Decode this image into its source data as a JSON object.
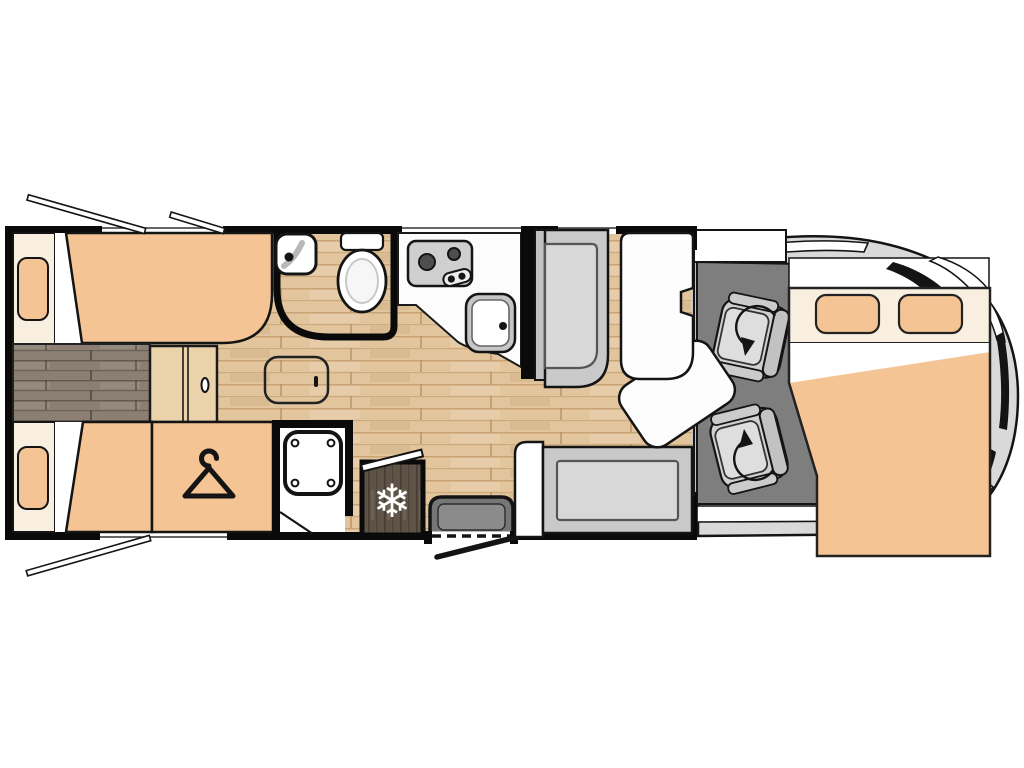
{
  "meta": {
    "title": "motorhome-floorplan-diagram",
    "canvas": {
      "width": 1024,
      "height": 768
    }
  },
  "colors": {
    "page_bg": "#ffffff",
    "outline": "#141414",
    "wall": "#0a0a0a",
    "mattress_orange": "#f5c494",
    "pillow_orange": "#f5c494",
    "cream": "#f9efe0",
    "wood_light_base": "#e2c59d",
    "wood_light_line": "#c19a6b",
    "wood_dark_base": "#8a7f72",
    "wood_dark_line": "#6a6156",
    "fridge_wood_base": "#5f5348",
    "fridge_wood_line": "#473d33",
    "cab_floor": "#7e7e7e",
    "vehicle_body": "#d9d9d9",
    "bench_outer": "#c9c9c9",
    "bench_back": "#c2c2c2",
    "cushion": "#d8d8d8",
    "cushion_edge": "#555555",
    "seat_base": "#d0d0d0",
    "seat_cushion": "#dedede",
    "counter_white": "#fcfcfc",
    "table_white": "#fdfdfd",
    "pure_white": "#ffffff",
    "stove_panel": "#cfcfcf",
    "burner_gray": "#4e4e4e",
    "sink_outer": "#c6c6c6",
    "step_fill": "#767676",
    "step_inner": "#8b8b8b",
    "basin_swoosh": "#b8b8b8",
    "toilet_inner": "#f6f6f6",
    "step_cabinet": "#ead2ab"
  },
  "icons": {
    "snowflake_glyph": "❄",
    "names": [
      "snowflake-icon",
      "hanger-icon",
      "rotation-arrow-icon",
      "window-flap",
      "door-swing-line"
    ]
  },
  "components": [
    "rear-twin-bed-upper",
    "rear-twin-bed-lower",
    "center-aisle",
    "aisle-step-cabinet",
    "wardrobe",
    "bathroom",
    "corner-washbasin",
    "toilet",
    "shower",
    "shower-tray",
    "kitchen-counter",
    "hob",
    "kitchen-sink",
    "refrigerator",
    "corridor-ottoman",
    "dinette-bench-forward",
    "dinette-bench-rear",
    "dinette-table",
    "table-leaf",
    "entry-step",
    "entry-door",
    "cab-floor",
    "swivel-seat-front",
    "swivel-seat-rear",
    "vehicle-front-body",
    "windshield",
    "drop-down-bed",
    "open-window-flaps"
  ]
}
